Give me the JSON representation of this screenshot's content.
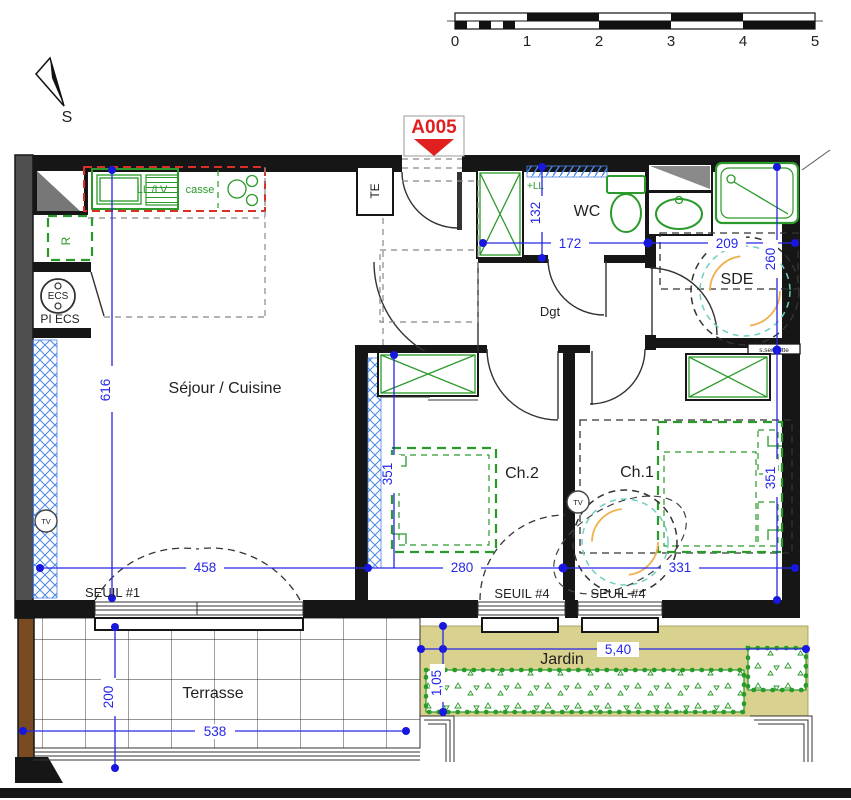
{
  "entry_tag": "A005",
  "north_label": "S",
  "scalebar": {
    "ticks": [
      "0",
      "1",
      "2",
      "3",
      "4",
      "5"
    ]
  },
  "rooms": {
    "sejour": "Séjour / Cuisine",
    "wc": "WC",
    "sde": "SDE",
    "dgt": "Dgt",
    "ch1": "Ch.1",
    "ch2": "Ch.2",
    "terrasse": "Terrasse",
    "jardin": "Jardin"
  },
  "equipment": {
    "te": "TE",
    "ll_lv": "LL /LV",
    "casse": "casse",
    "fridge": "R",
    "ecs": "ECS",
    "pi_ecs": "PI ECS",
    "plus_ll": "+LL",
    "tv": "TV",
    "towel_rail": "s.serviette"
  },
  "thresholds": {
    "seuil_1": "SEUIL #1",
    "seuil_4": "SEUIL #4"
  },
  "dimensions": {
    "sejour_height": "616",
    "sejour_width": "458",
    "ch2_width": "280",
    "ch1_width": "331",
    "ch2_height": "351",
    "ch1_height": "351",
    "wc_height": "132",
    "wc_width": "172",
    "sde_width": "209",
    "sde_height": "260",
    "terrasse_height": "200",
    "terrasse_width": "538",
    "jardin_width": "5,40",
    "jardin_depth": "1,05"
  },
  "colors": {
    "dimension_blue": "#2727e8",
    "fixture_green": "#2a9a2a",
    "kitchen_outline_red": "#d93025",
    "entry_tag_red": "#e02020",
    "jardin_fill": "#d9d28e",
    "terrace_wall_brown": "#7a4a22",
    "turning_circle_teal": "#6fcfc0",
    "turning_circle_orange": "#f0b050",
    "hatch_blue": "#4a86e8"
  }
}
